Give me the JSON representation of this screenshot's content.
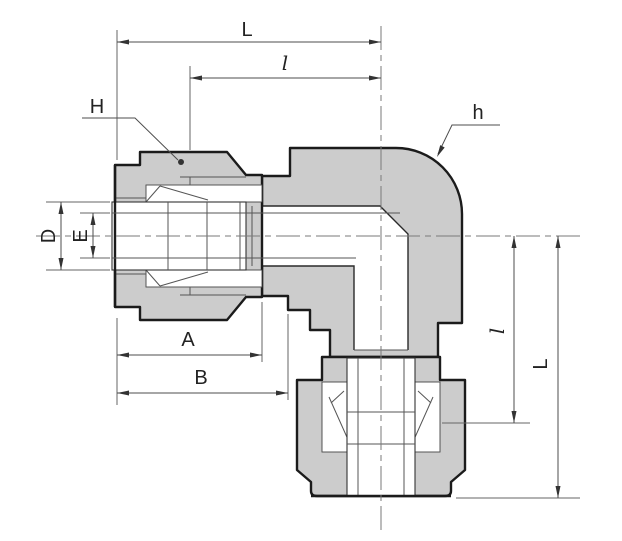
{
  "labels": {
    "length_overall_top": "L",
    "length_partial_top": "l",
    "nut_hex_H": "H",
    "body_hex_h": "h",
    "diameter_D": "D",
    "diameter_E": "E",
    "dim_A": "A",
    "dim_B": "B",
    "length_partial_right": "l",
    "length_overall_right": "L"
  },
  "colors": {
    "background": "#ffffff",
    "body_fill": "#e1e1e1",
    "nut_fill": "#c6c6c6",
    "tube_fill": "#ffffff",
    "bore_fill": "#ffffff",
    "outline": "#1b1b1b",
    "dimension_lines": "#4d4d4d",
    "label_text": "#222222"
  }
}
